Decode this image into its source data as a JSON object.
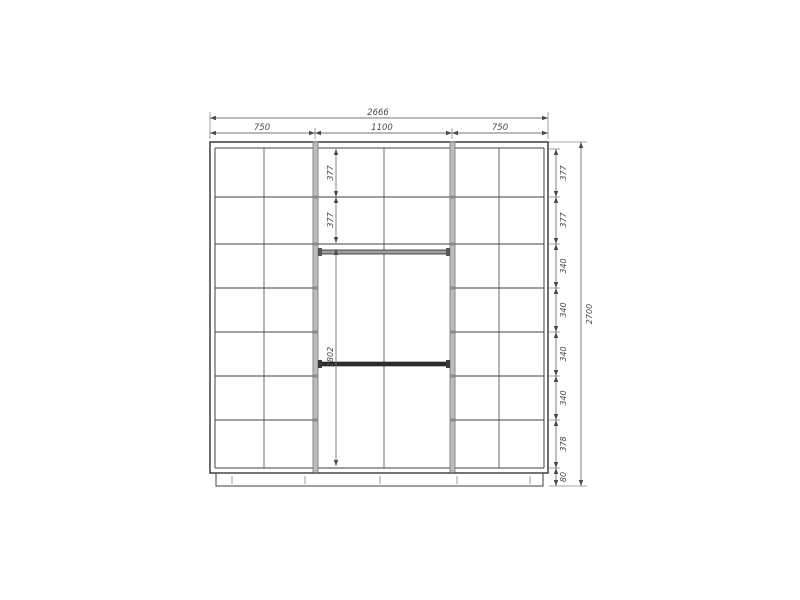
{
  "diagram": {
    "top": {
      "overall": "2666",
      "sections": [
        "750",
        "1100",
        "750"
      ]
    },
    "right": {
      "rows": [
        "377",
        "377",
        "340",
        "340",
        "340",
        "340",
        "378",
        "80"
      ],
      "overall": "2700"
    },
    "middle": {
      "rows": [
        "377",
        "377",
        "1802"
      ]
    },
    "colors": {
      "background": "#ffffff",
      "structure_line": "#3f3f3f",
      "panel_fill": "#bdbdbd",
      "panel_stroke": "#7f7f7f",
      "dimension_line": "#757575",
      "dimension_text": "#4a4a4a",
      "rod_dark": "#2e2e2e",
      "rod_light": "#9e9e9e"
    }
  }
}
